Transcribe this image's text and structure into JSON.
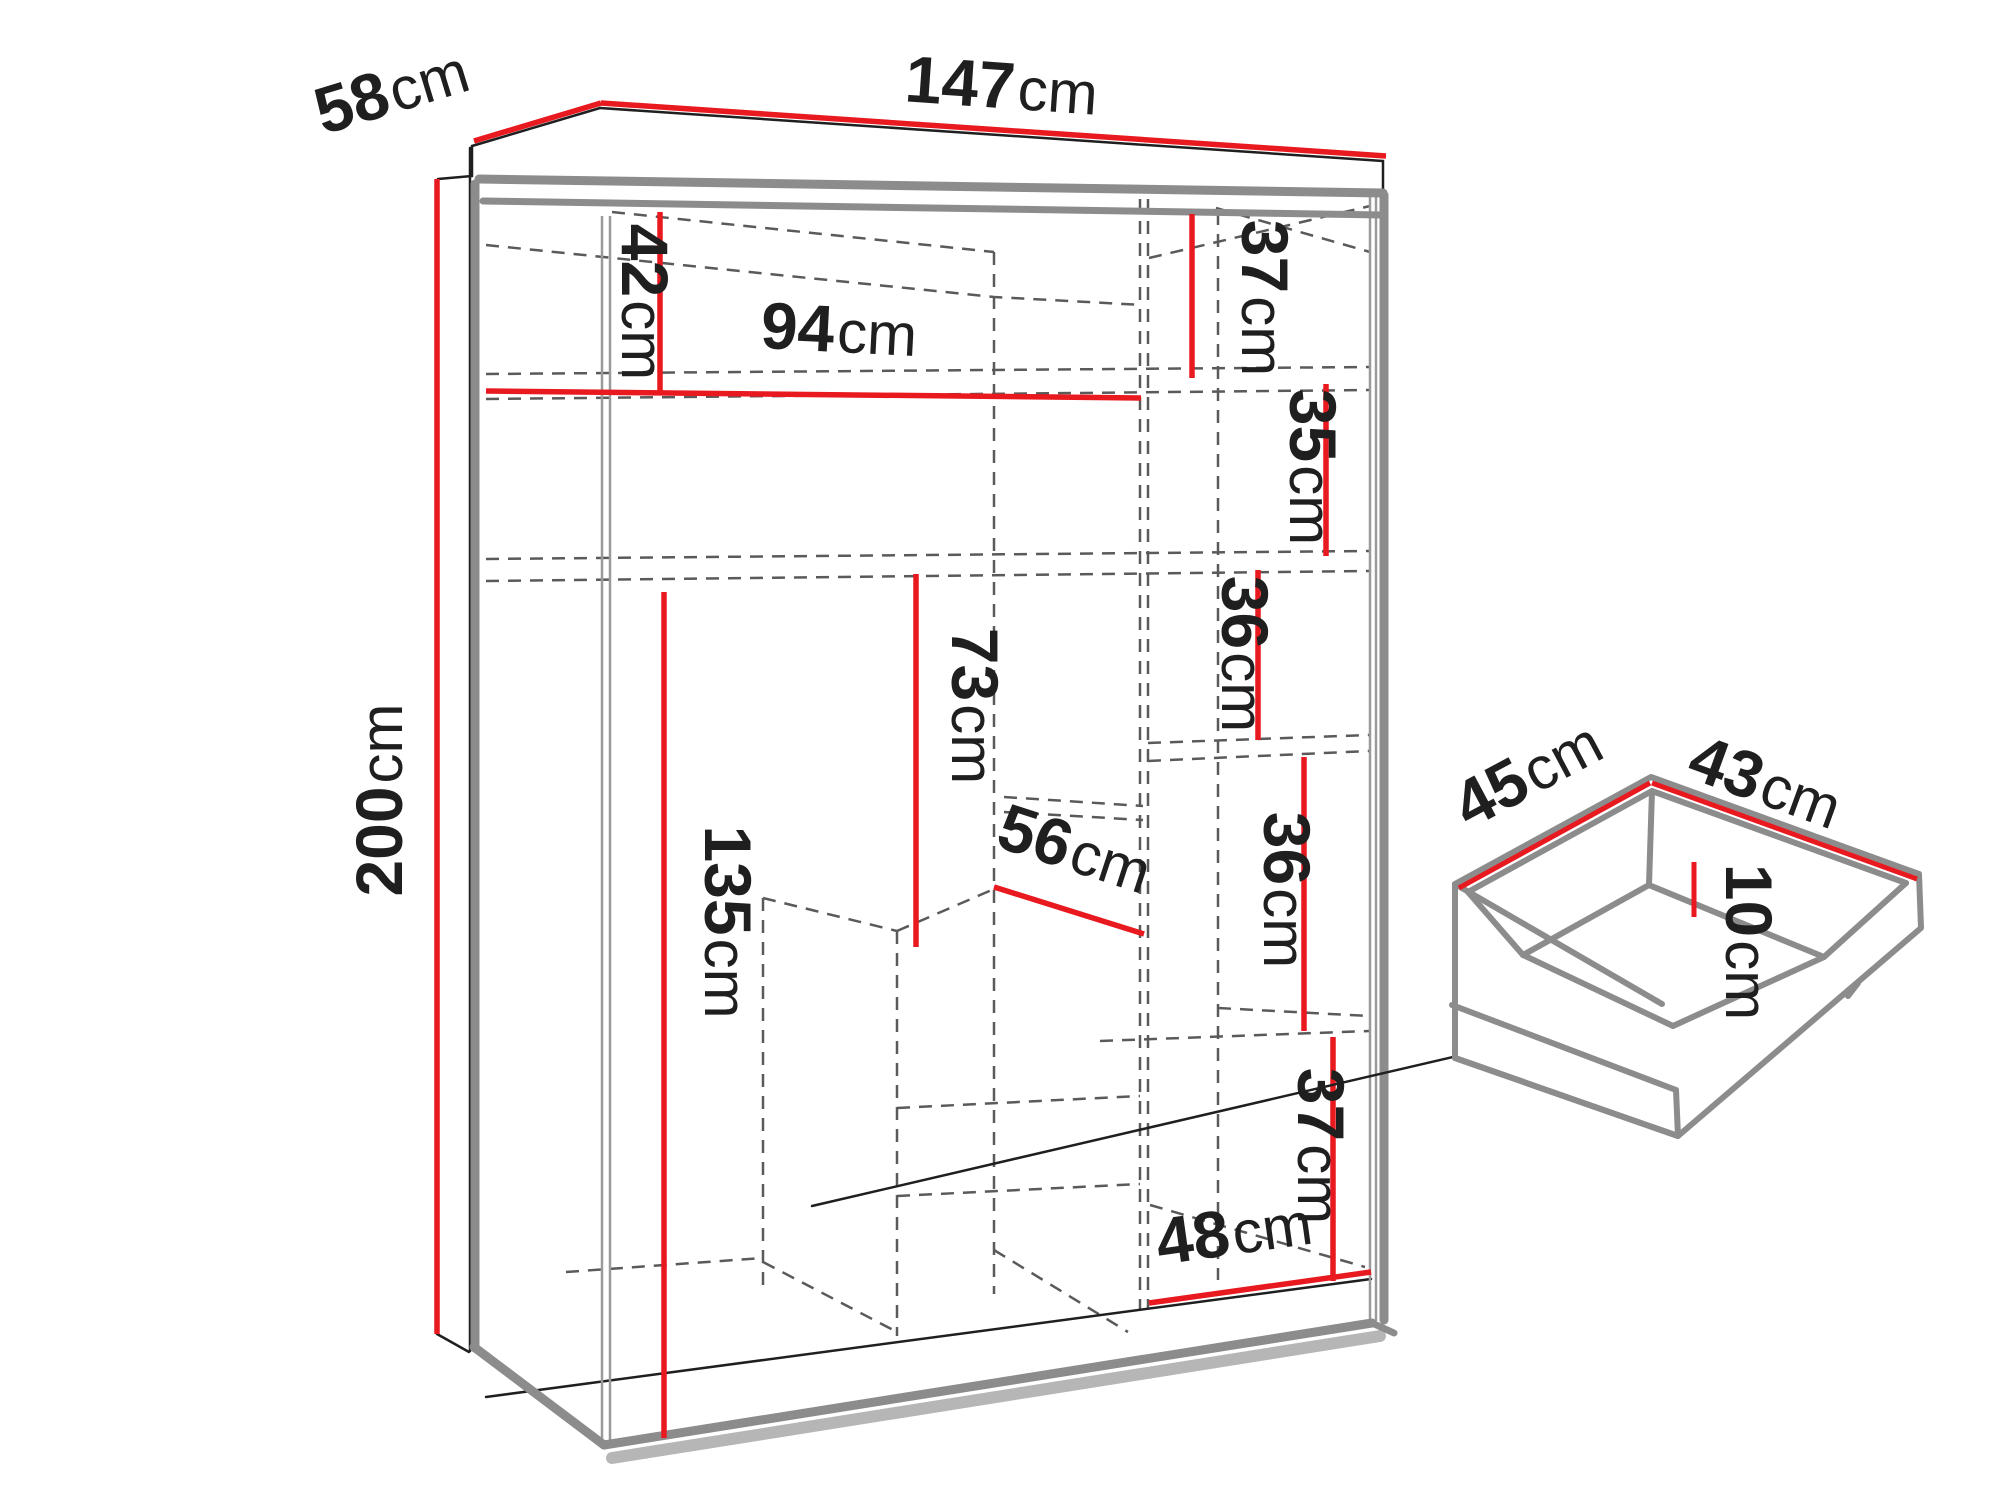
{
  "page": {
    "type": "furniture-dimension-diagram",
    "background": "#ffffff"
  },
  "colors": {
    "dimension_red": "#e8191f",
    "outline_black": "#1f1f1f",
    "panel_gray": "#8c8c8c",
    "panel_gray_light": "#a9a9a9",
    "dashed_gray": "#5a5a5a",
    "door_edge_gray": "#9a9a9a",
    "background": "#ffffff"
  },
  "wardrobe": {
    "overall": {
      "width": {
        "value": "147",
        "unit": "cm"
      },
      "depth": {
        "value": "58",
        "unit": "cm"
      },
      "height": {
        "value": "200",
        "unit": "cm"
      }
    },
    "interior": {
      "top_left_compartment_height": {
        "value": "42",
        "unit": "cm"
      },
      "left_section_width": {
        "value": "94",
        "unit": "cm"
      },
      "hanging_space_height": {
        "value": "73",
        "unit": "cm"
      },
      "left_lower_section_height": {
        "value": "135",
        "unit": "cm"
      },
      "drawer_unit_width": {
        "value": "56",
        "unit": "cm"
      },
      "right_compartment_1_height": {
        "value": "37",
        "unit": "cm"
      },
      "right_compartment_2_height": {
        "value": "35",
        "unit": "cm"
      },
      "right_compartment_3_height": {
        "value": "36",
        "unit": "cm"
      },
      "right_compartment_4_height": {
        "value": "36",
        "unit": "cm"
      },
      "right_compartment_5_height": {
        "value": "37",
        "unit": "cm"
      },
      "bottom_right_compartment_width": {
        "value": "48",
        "unit": "cm"
      }
    }
  },
  "drawer_detail": {
    "depth": {
      "value": "45",
      "unit": "cm"
    },
    "width": {
      "value": "43",
      "unit": "cm"
    },
    "inner_height": {
      "value": "10",
      "unit": "cm"
    }
  }
}
